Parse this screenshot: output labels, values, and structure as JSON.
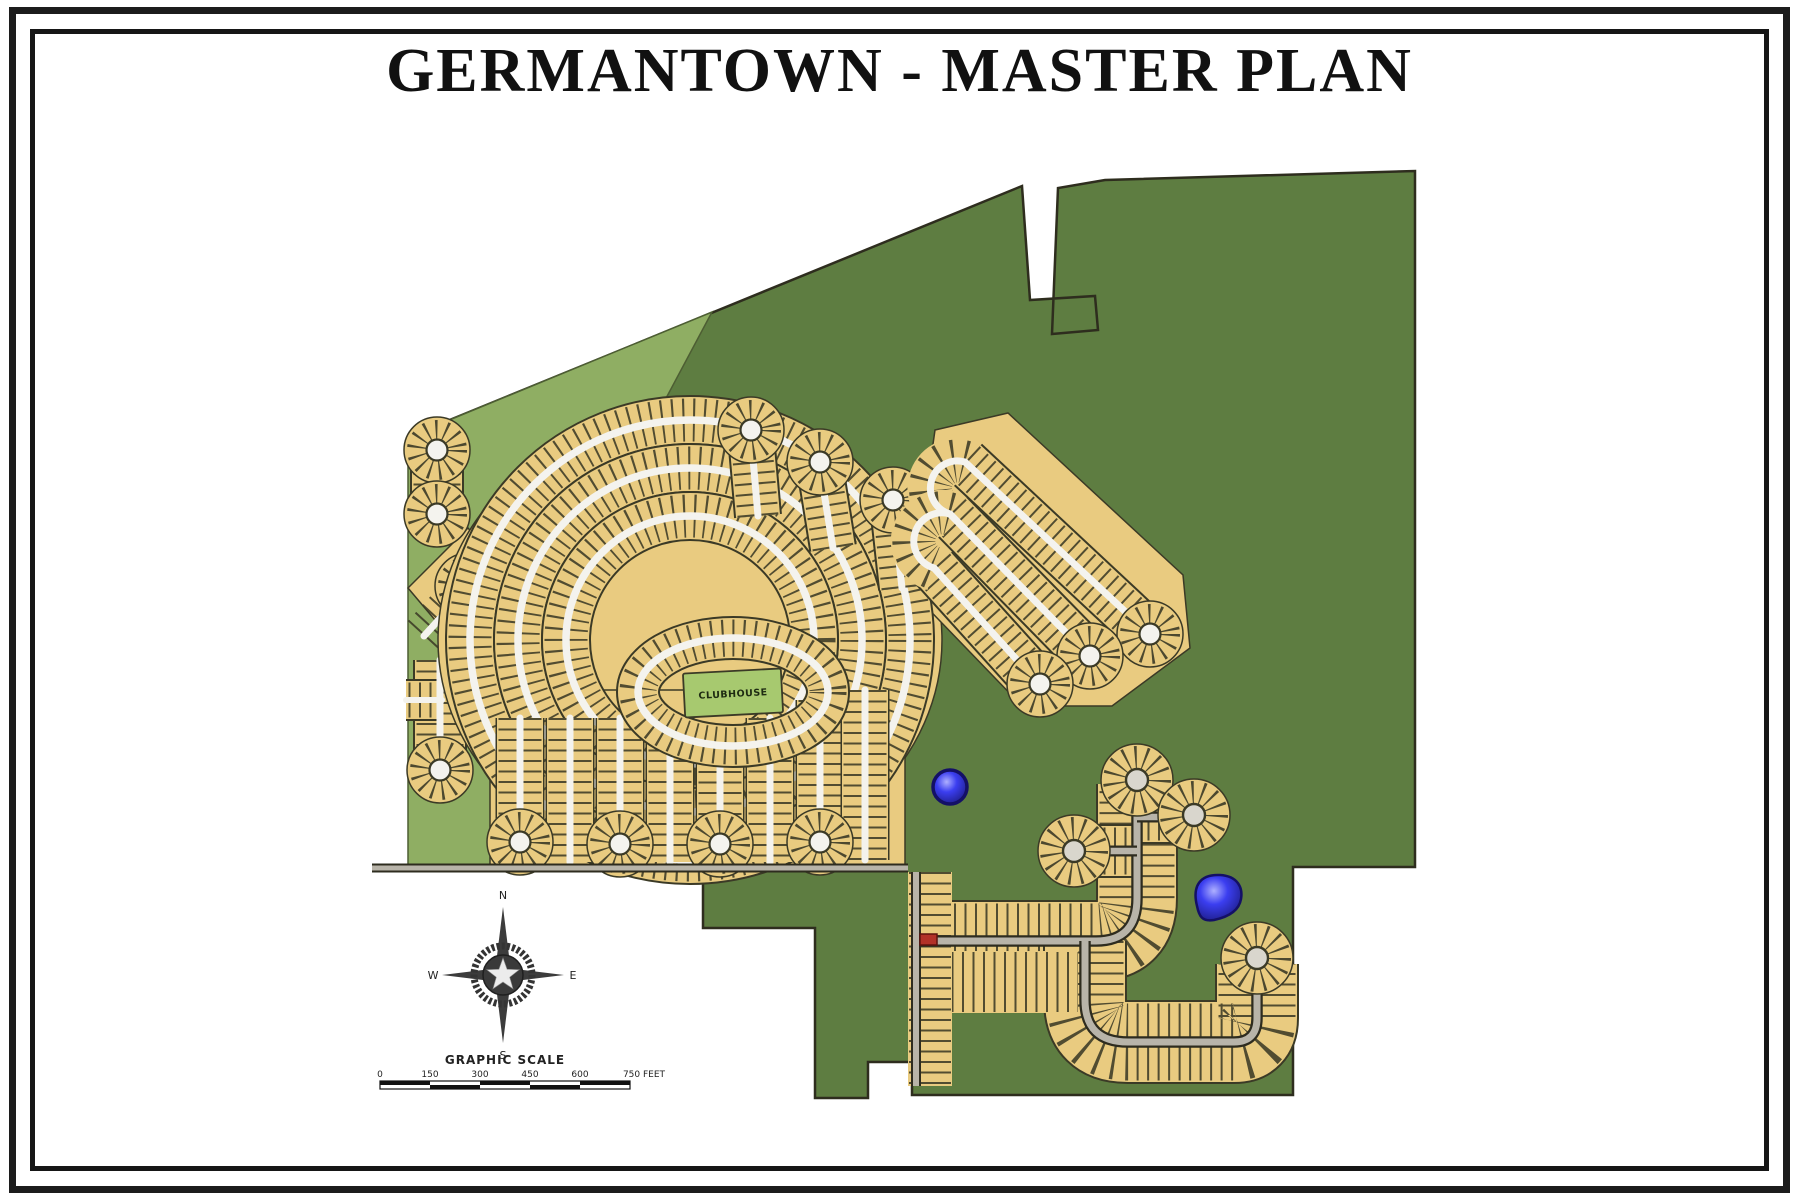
{
  "title": "GERMANTOWN - MASTER PLAN",
  "map": {
    "name": "Germantown master plan site map",
    "clubhouse_label": "CLUBHOUSE",
    "colors": {
      "open_space_dark_green": "#5e7d41",
      "open_space_light_green": "#8fae63",
      "residential_lots_tan": "#e9cb80",
      "local_street_white": "#f4f3ee",
      "collector_road_gray": "#b8b4a9",
      "pond_blue": "#3336e8",
      "lot_line_dark": "#3b3a26",
      "clubhouse_green": "#a7c96f"
    }
  },
  "compass": {
    "north": "N",
    "east": "E",
    "south": "S",
    "west": "W"
  },
  "scale": {
    "heading": "GRAPHIC SCALE",
    "labels": [
      "0",
      "150",
      "300",
      "450",
      "600",
      "750 FEET"
    ]
  }
}
